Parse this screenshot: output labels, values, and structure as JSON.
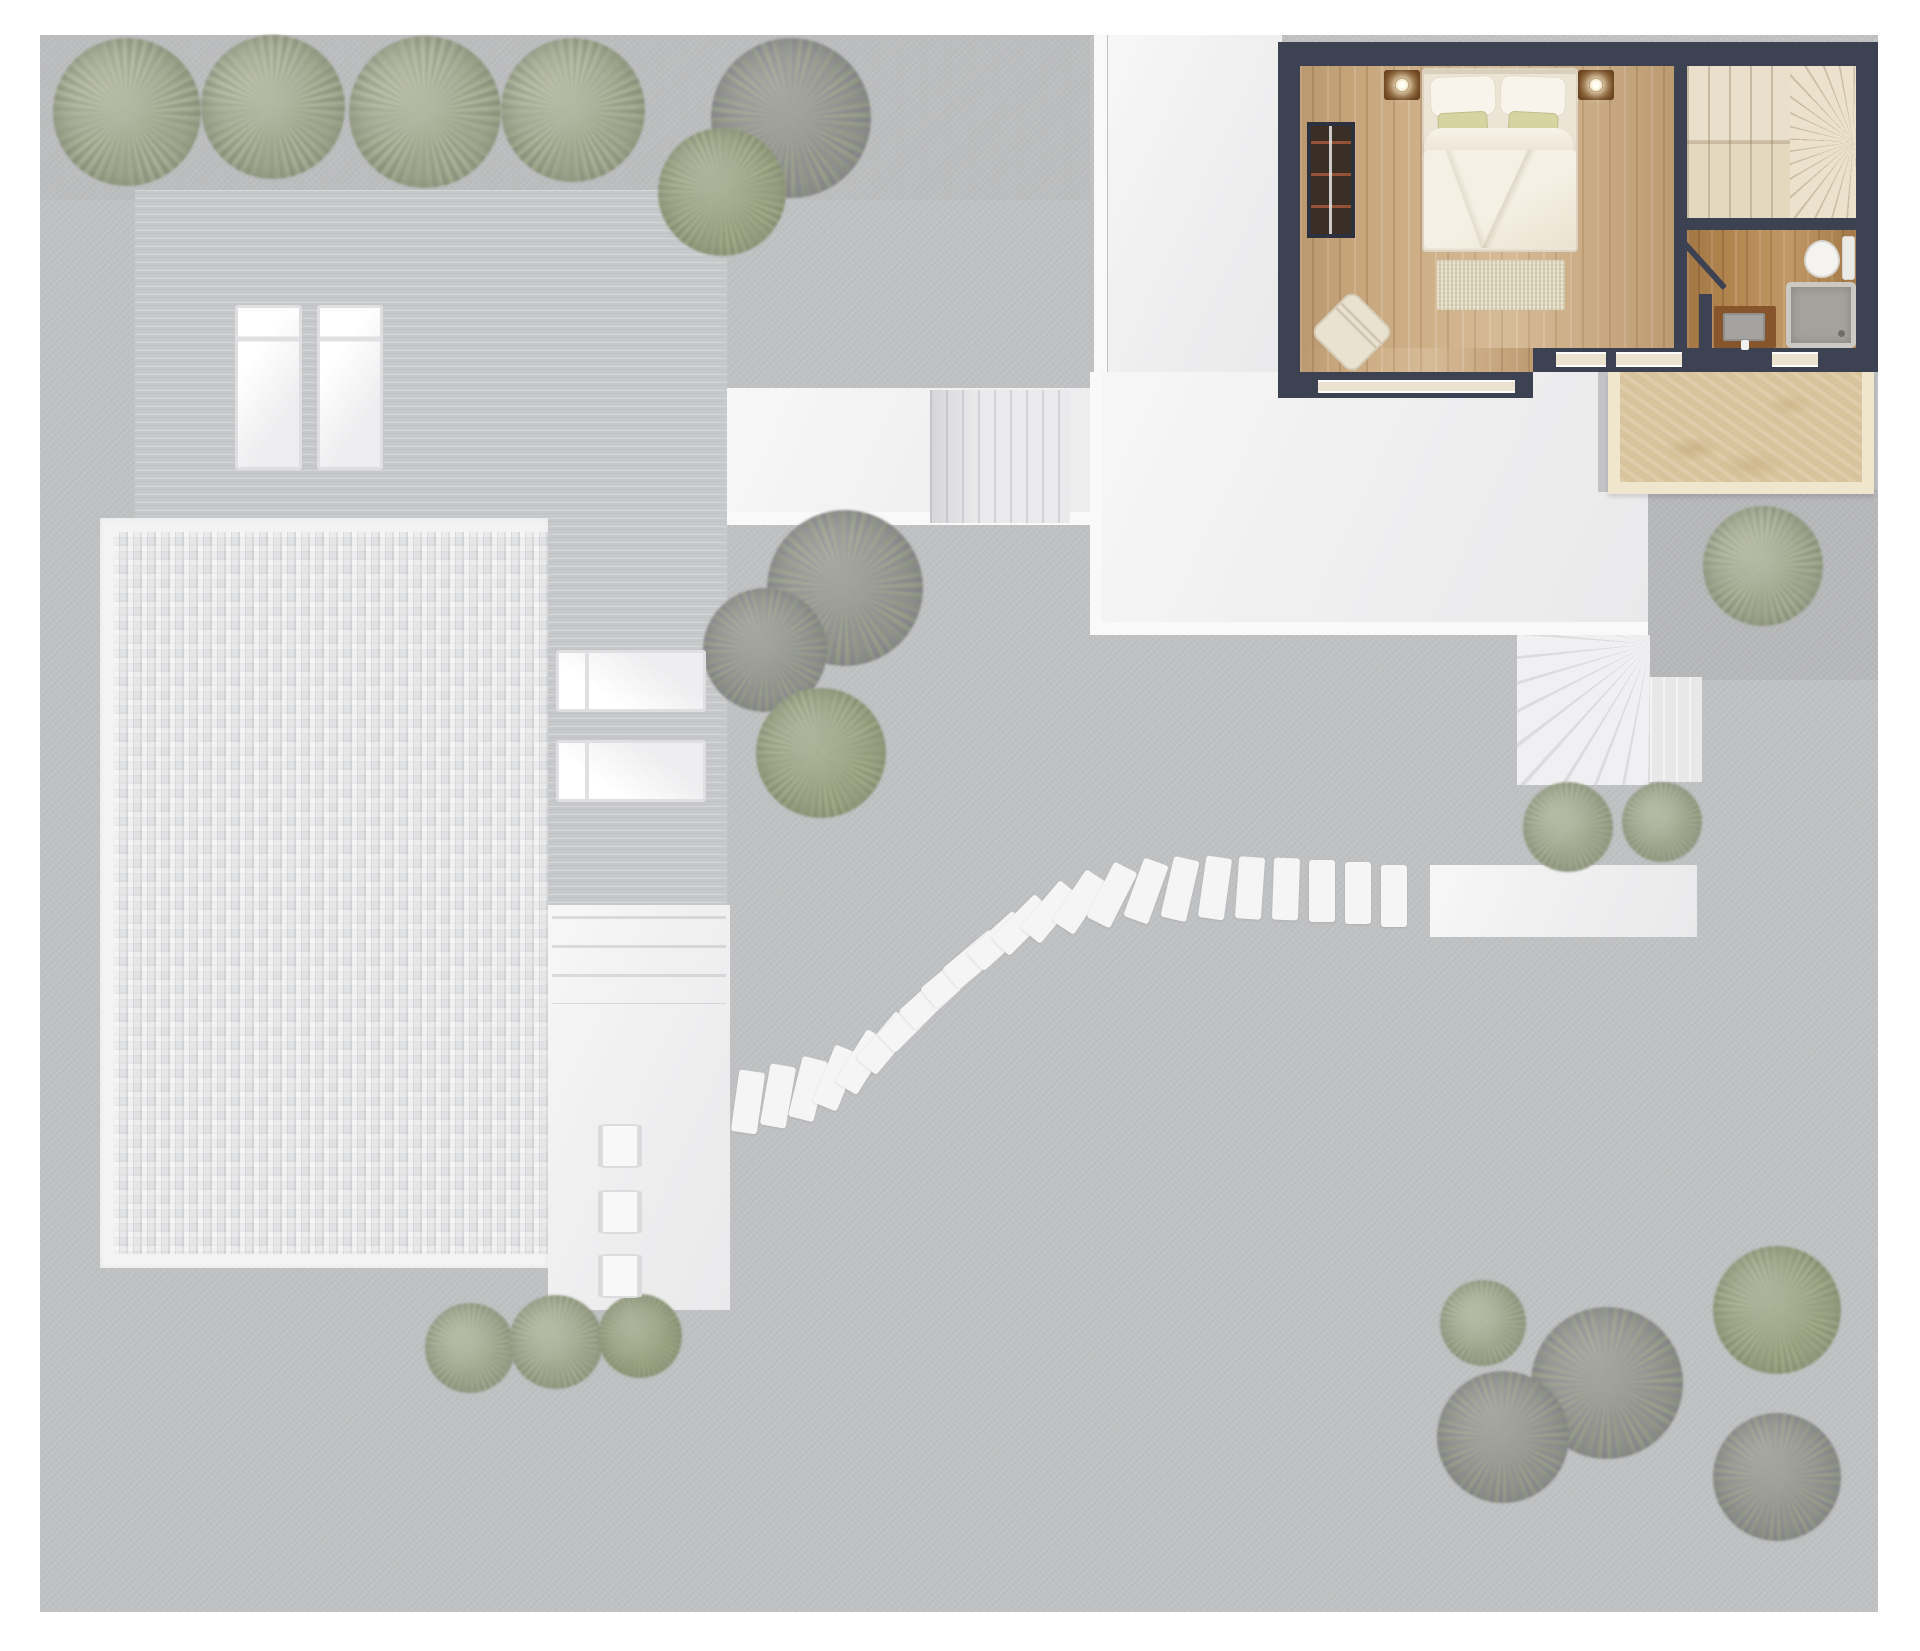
{
  "meta": {
    "kind": "architectural top-down site / floor plan render",
    "highlight": "upper-floor bedroom suite with bathroom, staircase and balcony shown in full color; ground-level garden, deck, pool and paths shown faded grey"
  },
  "palette": {
    "page_bg": "#ffffff",
    "lawn_grey": "#b6b7b9",
    "deck_grey": "#bfc0c2",
    "patio_white": "#ededee",
    "pool_tile": "#d6d7d9",
    "wall_navy": "#3c4252",
    "bedroom_wood": "#c9a87e",
    "bathroom_wood": "#b2854f",
    "stair_cream": "#e9dfca",
    "balcony_tan": "#d8c49c",
    "foliage_sage": "#8e957a",
    "foliage_dark": "#767b6d",
    "foliage_green": "#87906c",
    "accent_pillow_olive": "#d6d5a2"
  },
  "scene": {
    "canvas": {
      "w": 1920,
      "h": 1651
    },
    "elements": [
      {
        "n": "garden-ground",
        "k": "grass",
        "x": 40,
        "y": 35,
        "w": 1838,
        "h": 1577
      },
      {
        "n": "grass-shade-top",
        "k": "shade",
        "x": 40,
        "y": 35,
        "w": 1050,
        "h": 165
      },
      {
        "n": "wood-deck-main",
        "k": "deck",
        "x": 135,
        "y": 190,
        "w": 592,
        "h": 336
      },
      {
        "n": "wood-deck-column",
        "k": "deck",
        "x": 548,
        "y": 526,
        "w": 179,
        "h": 386
      },
      {
        "n": "pool-rim",
        "k": "rim",
        "x": 100,
        "y": 518,
        "w": 448,
        "h": 750
      },
      {
        "n": "pool-mosaic",
        "k": "mosaic",
        "x": 114,
        "y": 532,
        "w": 434,
        "h": 722
      },
      {
        "n": "patio-walk-strip",
        "k": "patio-light",
        "x": 548,
        "y": 905,
        "w": 182,
        "h": 405
      },
      {
        "n": "patio-steps",
        "k": "steps-h",
        "x": 552,
        "y": 916,
        "w": 174,
        "h": 88
      },
      {
        "n": "upper-walkway",
        "k": "patio-light",
        "x": 727,
        "y": 388,
        "w": 555,
        "h": 137
      },
      {
        "n": "walkway-edge-bottom",
        "k": "bright",
        "x": 727,
        "y": 512,
        "w": 555,
        "h": 13
      },
      {
        "n": "garden-stairs-straight",
        "k": "stairs-v",
        "x": 930,
        "y": 390,
        "w": 140,
        "h": 133
      },
      {
        "n": "patio-strip-vertical",
        "k": "patio-light",
        "x": 1108,
        "y": 35,
        "w": 174,
        "h": 353
      },
      {
        "n": "patio-edge-left",
        "k": "bright",
        "x": 1094,
        "y": 35,
        "w": 13,
        "h": 340
      },
      {
        "n": "lower-patio",
        "k": "patio-light",
        "x": 1090,
        "y": 372,
        "w": 558,
        "h": 263
      },
      {
        "n": "lower-patio-edge-left",
        "k": "bright",
        "x": 1090,
        "y": 372,
        "w": 11,
        "h": 263
      },
      {
        "n": "lower-patio-edge-bottom",
        "k": "bright",
        "x": 1090,
        "y": 622,
        "w": 558,
        "h": 13
      },
      {
        "n": "balcony-side-strip",
        "k": "grey-strip",
        "x": 1598,
        "y": 372,
        "w": 12,
        "h": 120
      },
      {
        "n": "paved-square",
        "k": "grass-dark",
        "x": 1648,
        "y": 490,
        "w": 230,
        "h": 190
      },
      {
        "n": "winder-stairs",
        "k": "stairs-fan",
        "x": 1517,
        "y": 635,
        "w": 133,
        "h": 150
      },
      {
        "n": "winder-stairs-ext",
        "k": "stairs-v2",
        "x": 1650,
        "y": 677,
        "w": 52,
        "h": 105
      },
      {
        "n": "path-strip-right",
        "k": "patio-light",
        "x": 1430,
        "y": 865,
        "w": 267,
        "h": 72
      },
      {
        "n": "tree-row-1",
        "k": "tree-sage",
        "x": 53,
        "y": 38,
        "w": 148,
        "h": 148
      },
      {
        "n": "tree-row-2",
        "k": "tree-sage",
        "x": 201,
        "y": 35,
        "w": 144,
        "h": 144
      },
      {
        "n": "tree-row-3",
        "k": "tree-sage",
        "x": 349,
        "y": 36,
        "w": 152,
        "h": 152
      },
      {
        "n": "tree-row-4",
        "k": "tree-sage",
        "x": 501,
        "y": 38,
        "w": 144,
        "h": 144
      },
      {
        "n": "bush-top-dark",
        "k": "tree-leafy",
        "x": 711,
        "y": 38,
        "w": 160,
        "h": 160
      },
      {
        "n": "bush-top-green",
        "k": "tree-green",
        "x": 658,
        "y": 128,
        "w": 128,
        "h": 128
      },
      {
        "n": "bush-mid-dark",
        "k": "tree-leafy",
        "x": 767,
        "y": 510,
        "w": 156,
        "h": 156
      },
      {
        "n": "bush-mid-left",
        "k": "tree-leafy",
        "x": 703,
        "y": 588,
        "w": 124,
        "h": 124
      },
      {
        "n": "bush-mid-green",
        "k": "tree-green",
        "x": 756,
        "y": 688,
        "w": 130,
        "h": 130
      },
      {
        "n": "bush-stairs-left",
        "k": "tree-sage",
        "x": 1523,
        "y": 782,
        "w": 90,
        "h": 90
      },
      {
        "n": "bush-stairs-right",
        "k": "tree-sage",
        "x": 1622,
        "y": 782,
        "w": 80,
        "h": 80
      },
      {
        "n": "bush-paved-square",
        "k": "tree-sage",
        "x": 1703,
        "y": 506,
        "w": 120,
        "h": 120
      },
      {
        "n": "bush-pool-1",
        "k": "tree-sage",
        "x": 425,
        "y": 1303,
        "w": 90,
        "h": 90
      },
      {
        "n": "bush-pool-2",
        "k": "tree-sage",
        "x": 509,
        "y": 1295,
        "w": 94,
        "h": 94
      },
      {
        "n": "bush-pool-3",
        "k": "tree-green",
        "x": 598,
        "y": 1294,
        "w": 84,
        "h": 84
      },
      {
        "n": "bush-br-small",
        "k": "tree-sage",
        "x": 1440,
        "y": 1280,
        "w": 86,
        "h": 86
      },
      {
        "n": "bush-br-big",
        "k": "tree-leafy",
        "x": 1531,
        "y": 1307,
        "w": 152,
        "h": 152
      },
      {
        "n": "bush-br-left",
        "k": "tree-leafy",
        "x": 1437,
        "y": 1371,
        "w": 132,
        "h": 132
      },
      {
        "n": "bush-br-topright",
        "k": "tree-green",
        "x": 1713,
        "y": 1246,
        "w": 128,
        "h": 128
      },
      {
        "n": "bush-br-bottomright",
        "k": "tree-leafy",
        "x": 1713,
        "y": 1413,
        "w": 128,
        "h": 128
      },
      {
        "n": "stepping-stone-01",
        "k": "stone",
        "x": 735,
        "y": 1071,
        "w": 26,
        "h": 62,
        "rot": 8
      },
      {
        "n": "stepping-stone-02",
        "k": "stone",
        "x": 765,
        "y": 1065,
        "w": 26,
        "h": 62,
        "rot": 10
      },
      {
        "n": "stepping-stone-03",
        "k": "stone",
        "x": 795,
        "y": 1058,
        "w": 26,
        "h": 62,
        "rot": 14
      },
      {
        "n": "stepping-stone-04",
        "k": "stone",
        "x": 823,
        "y": 1047,
        "w": 26,
        "h": 62,
        "rot": 22
      },
      {
        "n": "stepping-stone-05",
        "k": "stone",
        "x": 849,
        "y": 1031,
        "w": 26,
        "h": 62,
        "rot": 32
      },
      {
        "n": "stepping-stone-06",
        "k": "stone",
        "x": 873,
        "y": 1012,
        "w": 26,
        "h": 62,
        "rot": 40
      },
      {
        "n": "stepping-stone-07",
        "k": "stone",
        "x": 895,
        "y": 991,
        "w": 26,
        "h": 62,
        "rot": 45
      },
      {
        "n": "stepping-stone-08",
        "k": "stone",
        "x": 917,
        "y": 969,
        "w": 26,
        "h": 62,
        "rot": 48
      },
      {
        "n": "stepping-stone-09",
        "k": "stone",
        "x": 939,
        "y": 948,
        "w": 26,
        "h": 62,
        "rot": 50
      },
      {
        "n": "stepping-stone-10",
        "k": "stone",
        "x": 961,
        "y": 928,
        "w": 26,
        "h": 62,
        "rot": 50
      },
      {
        "n": "stepping-stone-11",
        "k": "stone",
        "x": 985,
        "y": 910,
        "w": 26,
        "h": 62,
        "rot": 48
      },
      {
        "n": "stepping-stone-12",
        "k": "stone",
        "x": 1009,
        "y": 894,
        "w": 26,
        "h": 62,
        "rot": 45
      },
      {
        "n": "stepping-stone-13",
        "k": "stone",
        "x": 1037,
        "y": 881,
        "w": 26,
        "h": 62,
        "rot": 40
      },
      {
        "n": "stepping-stone-14",
        "k": "stone",
        "x": 1067,
        "y": 871,
        "w": 26,
        "h": 62,
        "rot": 34
      },
      {
        "n": "stepping-stone-15",
        "k": "stone",
        "x": 1099,
        "y": 864,
        "w": 26,
        "h": 62,
        "rot": 27
      },
      {
        "n": "stepping-stone-16",
        "k": "stone",
        "x": 1133,
        "y": 860,
        "w": 26,
        "h": 62,
        "rot": 20
      },
      {
        "n": "stepping-stone-17",
        "k": "stone",
        "x": 1167,
        "y": 858,
        "w": 26,
        "h": 62,
        "rot": 13
      },
      {
        "n": "stepping-stone-18",
        "k": "stone",
        "x": 1202,
        "y": 857,
        "w": 26,
        "h": 62,
        "rot": 8
      },
      {
        "n": "stepping-stone-19",
        "k": "stone",
        "x": 1237,
        "y": 857,
        "w": 26,
        "h": 62,
        "rot": 4
      },
      {
        "n": "stepping-stone-20",
        "k": "stone",
        "x": 1273,
        "y": 858,
        "w": 26,
        "h": 62,
        "rot": 2
      },
      {
        "n": "stepping-stone-21",
        "k": "stone",
        "x": 1309,
        "y": 860,
        "w": 26,
        "h": 62,
        "rot": 0
      },
      {
        "n": "stepping-stone-22",
        "k": "stone",
        "x": 1345,
        "y": 862,
        "w": 26,
        "h": 62,
        "rot": 0
      },
      {
        "n": "stepping-stone-23",
        "k": "stone",
        "x": 1381,
        "y": 865,
        "w": 26,
        "h": 62,
        "rot": 0
      },
      {
        "n": "sun-lounger-1",
        "k": "lounger",
        "x": 235,
        "y": 305,
        "w": 67,
        "h": 165
      },
      {
        "n": "sun-lounger-2",
        "k": "lounger",
        "x": 317,
        "y": 305,
        "w": 66,
        "h": 165
      },
      {
        "n": "sun-lounger-3",
        "k": "lounger-h",
        "x": 556,
        "y": 650,
        "w": 150,
        "h": 62
      },
      {
        "n": "sun-lounger-4",
        "k": "lounger-h",
        "x": 556,
        "y": 740,
        "w": 150,
        "h": 62
      },
      {
        "n": "patio-chair-1",
        "k": "chair-small",
        "x": 601,
        "y": 1124,
        "w": 38,
        "h": 44
      },
      {
        "n": "patio-chair-2",
        "k": "chair-small",
        "x": 601,
        "y": 1190,
        "w": 38,
        "h": 44
      },
      {
        "n": "patio-chair-3",
        "k": "chair-small",
        "x": 601,
        "y": 1254,
        "w": 38,
        "h": 44
      },
      {
        "n": "ground-floor-veil",
        "k": "veil",
        "x": 40,
        "y": 35,
        "w": 1838,
        "h": 1577
      },
      {
        "n": "house-walls",
        "k": "wall",
        "x": 1278,
        "y": 42,
        "w": 600,
        "h": 330
      },
      {
        "n": "bedroom-floor",
        "k": "wood-light",
        "x": 1300,
        "y": 66,
        "w": 374,
        "h": 282
      },
      {
        "n": "bedroom-floor-ext",
        "k": "wood-light",
        "x": 1300,
        "y": 348,
        "w": 233,
        "h": 30
      },
      {
        "n": "stairs-upper-flight",
        "k": "stairs-house",
        "x": 1687,
        "y": 66,
        "w": 103,
        "h": 76
      },
      {
        "n": "stairs-lower-flight",
        "k": "stairs-house2",
        "x": 1687,
        "y": 142,
        "w": 103,
        "h": 76
      },
      {
        "n": "stairs-winder-top",
        "k": "stairs-house-fan",
        "x": 1790,
        "y": 66,
        "w": 66,
        "h": 152
      },
      {
        "n": "bathroom-floor",
        "k": "wood-dark",
        "x": 1687,
        "y": 230,
        "w": 169,
        "h": 118
      },
      {
        "n": "bedroom-south-wall",
        "k": "wall",
        "x": 1278,
        "y": 372,
        "w": 255,
        "h": 26
      },
      {
        "n": "window-bedroom",
        "k": "window-sill",
        "x": 1318,
        "y": 380,
        "w": 197,
        "h": 13
      },
      {
        "n": "window-bath-1",
        "k": "window-sill",
        "x": 1556,
        "y": 352,
        "w": 50,
        "h": 15
      },
      {
        "n": "window-bath-2",
        "k": "window-sill",
        "x": 1616,
        "y": 352,
        "w": 66,
        "h": 15
      },
      {
        "n": "window-bath-3",
        "k": "window-sill",
        "x": 1772,
        "y": 352,
        "w": 46,
        "h": 15
      },
      {
        "n": "bathroom-door-leaf",
        "k": "door-line",
        "x": 1701,
        "y": 234,
        "w": 6,
        "h": 62,
        "rot": -42
      },
      {
        "n": "bathroom-partition-wall",
        "k": "wall",
        "x": 1699,
        "y": 294,
        "w": 13,
        "h": 54
      },
      {
        "n": "toilet-tank",
        "k": "toilet-tank",
        "x": 1842,
        "y": 236,
        "w": 13,
        "h": 44
      },
      {
        "n": "toilet-bowl",
        "k": "toilet-bowl",
        "x": 1804,
        "y": 240,
        "w": 36,
        "h": 38
      },
      {
        "n": "shower-tray",
        "k": "shower",
        "x": 1786,
        "y": 282,
        "w": 70,
        "h": 66
      },
      {
        "n": "shower-drain",
        "k": "drain",
        "x": 1838,
        "y": 330,
        "w": 7,
        "h": 7
      },
      {
        "n": "vanity-cabinet",
        "k": "vanity",
        "x": 1714,
        "y": 306,
        "w": 62,
        "h": 42
      },
      {
        "n": "vanity-basin",
        "k": "basin",
        "x": 1723,
        "y": 313,
        "w": 42,
        "h": 28
      },
      {
        "n": "vanity-tap",
        "k": "tap",
        "x": 1741,
        "y": 340,
        "w": 8,
        "h": 10
      },
      {
        "n": "wardrobe",
        "k": "wardrobe",
        "x": 1307,
        "y": 122,
        "w": 48,
        "h": 116
      },
      {
        "n": "nightstand-left",
        "k": "nightstand",
        "x": 1384,
        "y": 70,
        "w": 36,
        "h": 30
      },
      {
        "n": "lamp-left",
        "k": "lamp",
        "x": 1395,
        "y": 78,
        "w": 14,
        "h": 14
      },
      {
        "n": "nightstand-right",
        "k": "nightstand",
        "x": 1578,
        "y": 70,
        "w": 36,
        "h": 30
      },
      {
        "n": "lamp-right",
        "k": "lamp",
        "x": 1589,
        "y": 78,
        "w": 14,
        "h": 14
      },
      {
        "n": "bed",
        "k": "bed-base",
        "x": 1422,
        "y": 68,
        "w": 156,
        "h": 184
      },
      {
        "n": "pillow-left",
        "k": "pillow",
        "x": 1430,
        "y": 76,
        "w": 66,
        "h": 40,
        "rot": -2
      },
      {
        "n": "pillow-right",
        "k": "pillow",
        "x": 1500,
        "y": 76,
        "w": 66,
        "h": 40,
        "rot": 2
      },
      {
        "n": "accent-pillow-left",
        "k": "pillow-accent",
        "x": 1438,
        "y": 112,
        "w": 50,
        "h": 34,
        "rot": -3
      },
      {
        "n": "accent-pillow-right",
        "k": "pillow-accent",
        "x": 1508,
        "y": 112,
        "w": 50,
        "h": 34,
        "rot": 3
      },
      {
        "n": "blanket-roll",
        "k": "roll",
        "x": 1424,
        "y": 128,
        "w": 150,
        "h": 38
      },
      {
        "n": "duvet",
        "k": "duvet",
        "x": 1424,
        "y": 150,
        "w": 152,
        "h": 98
      },
      {
        "n": "bed-rug",
        "k": "rug",
        "x": 1437,
        "y": 260,
        "w": 128,
        "h": 50
      },
      {
        "n": "armchair",
        "k": "armchair",
        "x": 1322,
        "y": 302,
        "w": 60,
        "h": 60,
        "rot": 45
      },
      {
        "n": "balcony-frame",
        "k": "balcony-frame",
        "x": 1608,
        "y": 372,
        "w": 266,
        "h": 122
      },
      {
        "n": "balcony-floor",
        "k": "balcony-floor",
        "x": 1620,
        "y": 372,
        "w": 242,
        "h": 110
      }
    ]
  }
}
